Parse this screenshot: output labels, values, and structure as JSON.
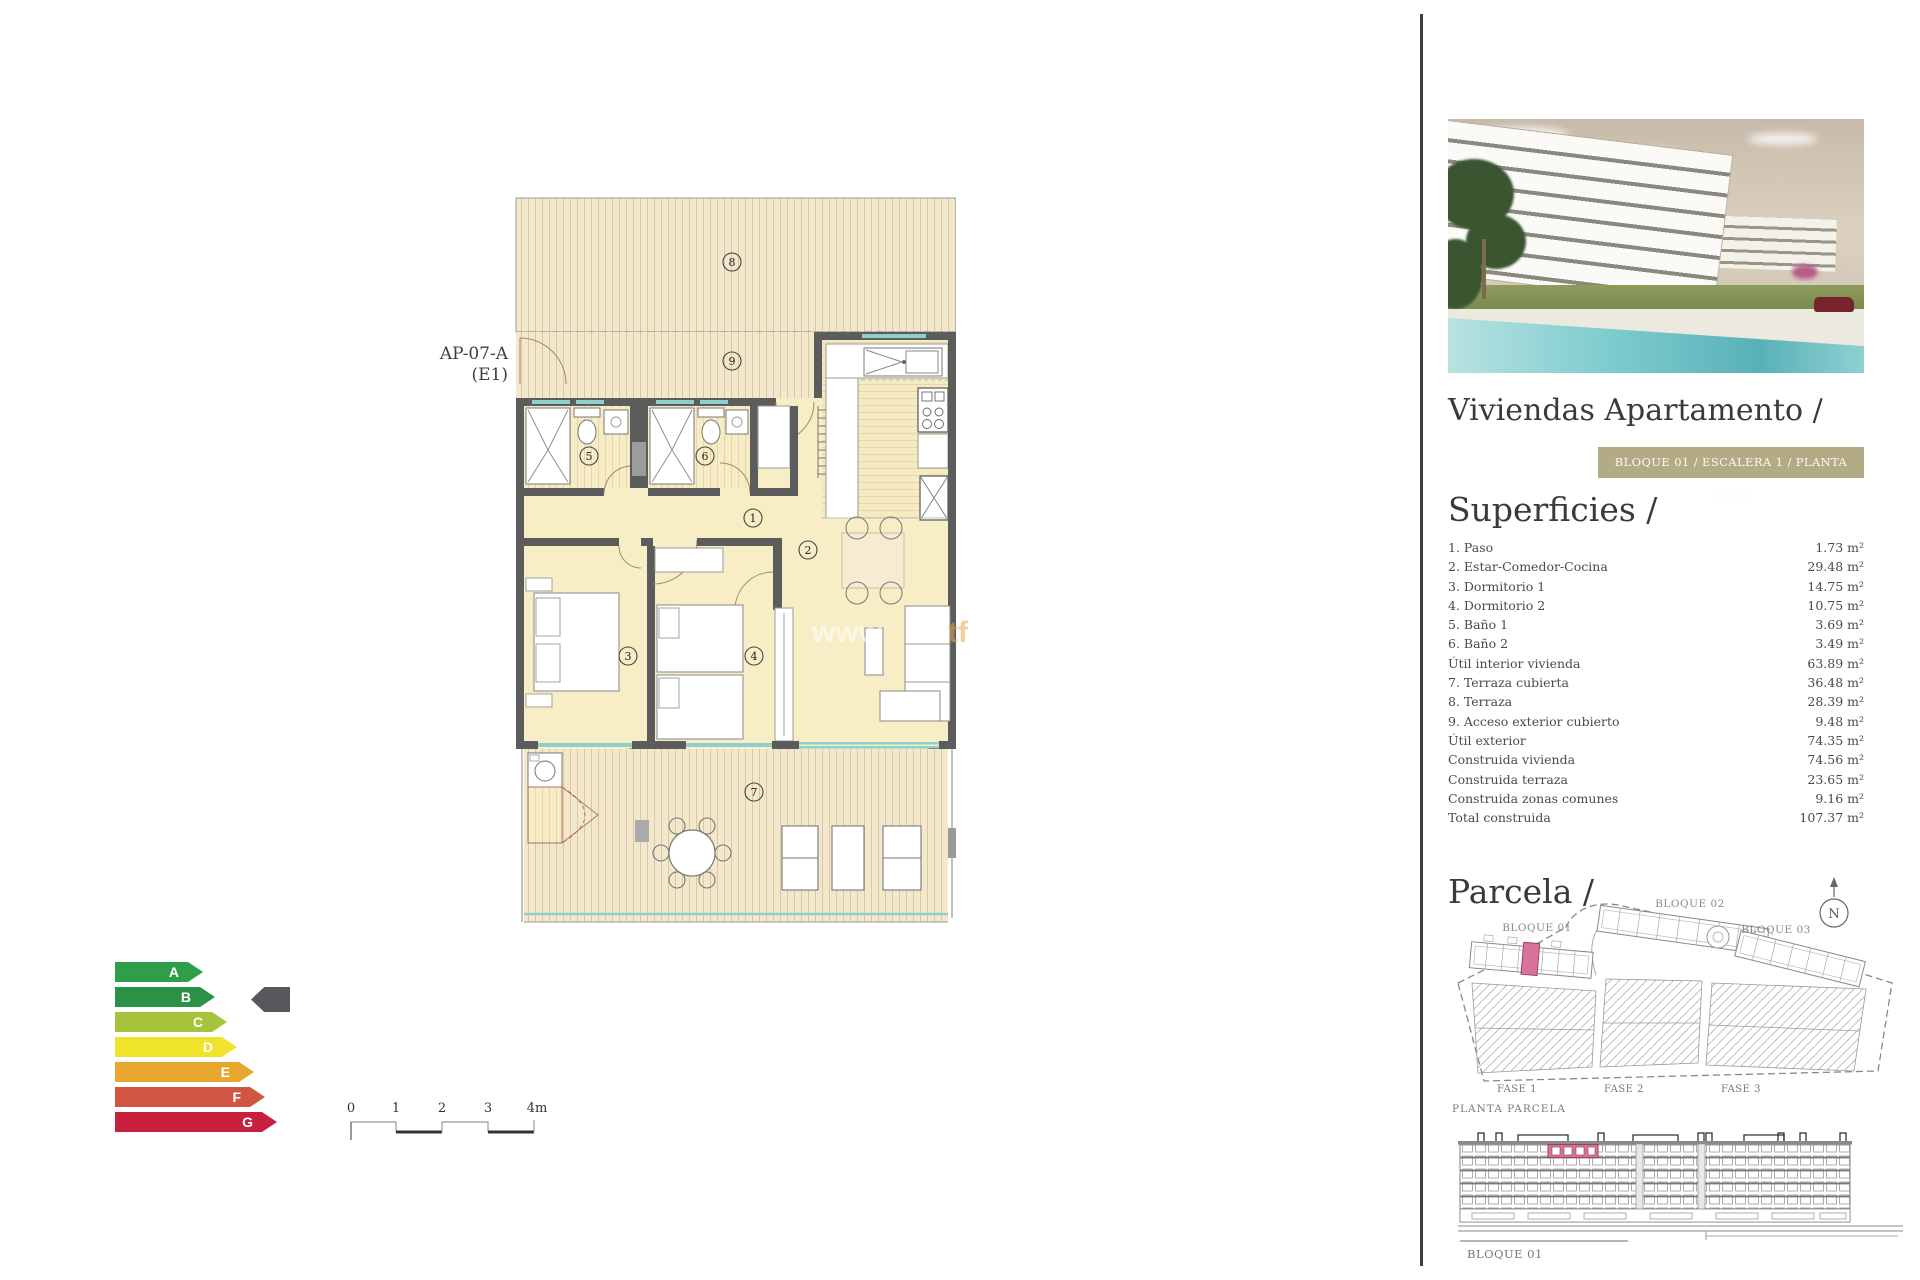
{
  "plan": {
    "unit_label_line1": "AP-07-A",
    "unit_label_line2": "(E1)",
    "rooms": [
      "1",
      "2",
      "3",
      "4",
      "5",
      "6",
      "7",
      "8",
      "9"
    ],
    "watermark_left": "www",
    "watermark_right": "tf"
  },
  "scale_bar": {
    "ticks": [
      "0",
      "1",
      "2",
      "3",
      "4m"
    ]
  },
  "energy_chart": {
    "ratings": [
      {
        "letter": "A",
        "color": "#2f9e48",
        "width": 88
      },
      {
        "letter": "B",
        "color": "#2a9147",
        "width": 100
      },
      {
        "letter": "C",
        "color": "#a5c43c",
        "width": 112
      },
      {
        "letter": "D",
        "color": "#efe32b",
        "width": 122
      },
      {
        "letter": "E",
        "color": "#e7a62e",
        "width": 139
      },
      {
        "letter": "F",
        "color": "#d15543",
        "width": 150
      },
      {
        "letter": "G",
        "color": "#c8203c",
        "width": 162
      }
    ],
    "indicator_row": "B",
    "indicator_color": "#57585c"
  },
  "sidebar": {
    "title": "Viviendas Apartamento /",
    "banner": "BLOQUE 01 / ESCALERA 1 / PLANTA ÁTICO",
    "banner_color": "#b3ab85",
    "superficies": {
      "heading": "Superficies /",
      "rows": [
        {
          "label": "1. Paso",
          "value": "1.73 m²"
        },
        {
          "label": "2. Estar-Comedor-Cocina",
          "value": "29.48 m²"
        },
        {
          "label": "3. Dormitorio 1",
          "value": "14.75 m²"
        },
        {
          "label": "4. Dormitorio 2",
          "value": "10.75 m²"
        },
        {
          "label": "5. Baño 1",
          "value": "3.69 m²"
        },
        {
          "label": "6. Baño 2",
          "value": "3.49 m²"
        },
        {
          "label": "Útil interior vivienda",
          "value": "63.89 m²"
        },
        {
          "label": "7. Terraza cubierta",
          "value": "36.48 m²"
        },
        {
          "label": "8. Terraza",
          "value": "28.39 m²"
        },
        {
          "label": "9. Acceso exterior cubierto",
          "value": "9.48 m²"
        },
        {
          "label": "Útil exterior",
          "value": "74.35 m²"
        },
        {
          "label": "Construida vivienda",
          "value": "74.56 m²"
        },
        {
          "label": "Construida terraza",
          "value": "23.65 m²"
        },
        {
          "label": "Construida zonas comunes",
          "value": "9.16 m²"
        },
        {
          "label": "Total construida",
          "value": "107.37 m²"
        }
      ]
    },
    "parcela": {
      "heading": "Parcela /",
      "blocks": [
        "BLOQUE 01",
        "BLOQUE 02",
        "BLOQUE 03"
      ],
      "fases": [
        "FASE 1",
        "FASE 2",
        "FASE 3"
      ],
      "caption": "PLANTA PARCELA",
      "north_label": "N",
      "highlight_color": "#d9739a"
    },
    "elevation": {
      "caption": "BLOQUE 01"
    }
  }
}
